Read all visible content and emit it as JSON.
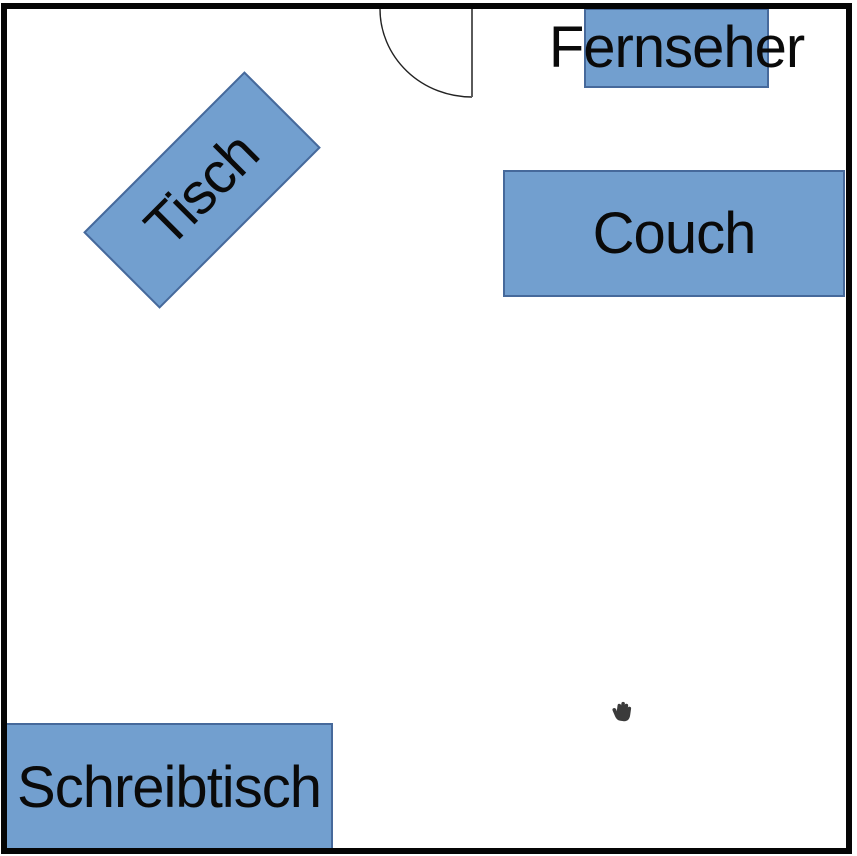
{
  "furniture": {
    "tisch": {
      "label": "Tisch"
    },
    "couch": {
      "label": "Couch"
    },
    "fernseher": {
      "label": "Fernseher"
    },
    "schreibtisch": {
      "label": "Schreibtisch"
    }
  },
  "door": {
    "type": "door-swing-quarter-arc",
    "position": "top-wall"
  },
  "cursor": {
    "icon": "grab-hand-cursor-icon"
  },
  "colors": {
    "furniture_fill": "#729FCF",
    "furniture_border": "#46699B",
    "wall": "#050505",
    "cursor_fill": "#3B3B3B",
    "label_color": "#0a0a0a"
  }
}
